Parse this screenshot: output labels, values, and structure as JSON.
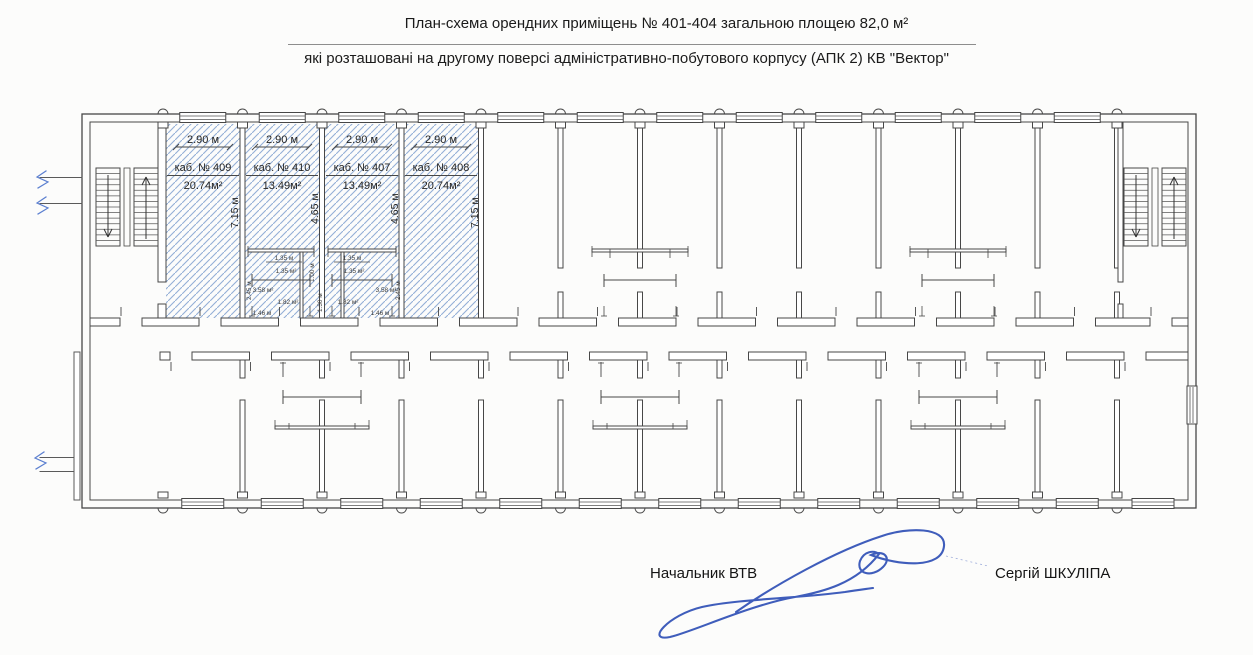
{
  "document": {
    "title_line1": "План-схема орендних приміщень № 401-404 загальною площею 82,0 м²",
    "title_line2": "які розташовані на другому поверсі адміністративно-побутового корпусу  (АПК 2) КВ \"Вектор\""
  },
  "plan": {
    "rooms": [
      {
        "name": "каб. № 409",
        "area": "20.74м²",
        "width_dim": "2.90 м",
        "depth_dim": "7.15 м"
      },
      {
        "name": "каб. № 410",
        "area": "13.49м²",
        "width_dim": "2.90 м",
        "depth_dim": "4.65 м"
      },
      {
        "name": "каб. № 407",
        "area": "13.49м²",
        "width_dim": "2.90 м",
        "depth_dim": "4.65 м"
      },
      {
        "name": "каб. № 408",
        "area": "20.74м²",
        "width_dim": "2.90 м",
        "depth_dim": "7.15 м"
      }
    ],
    "inner_dims": {
      "w135": "1.35 м",
      "a135": "1.35 м²",
      "a358": "3.58 м²",
      "a182": "1.82 м²",
      "w146": "1.46 м",
      "h245": "2.45 м",
      "h100": "1.00 м",
      "h130": "1.30 м"
    },
    "colors": {
      "hatch_blue": "#93afd6",
      "ink": "#474747",
      "signature_blue": "#2f4fb5"
    }
  },
  "footer": {
    "role": "Начальник ВТВ",
    "name": "Сергій ШКУЛІПА"
  }
}
